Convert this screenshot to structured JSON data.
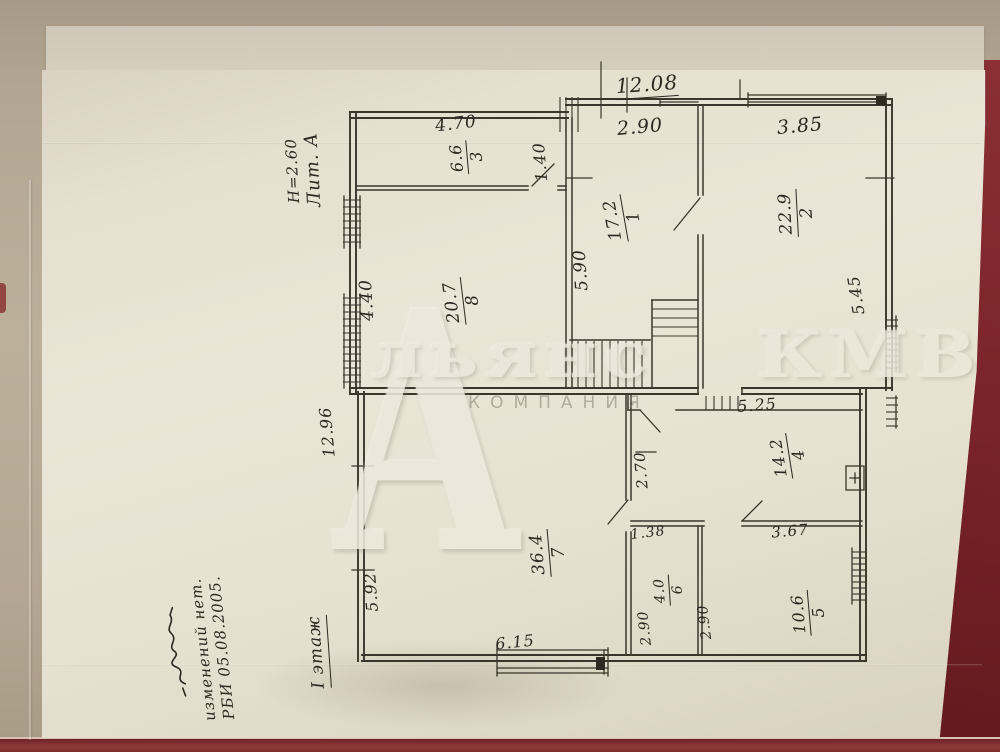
{
  "watermark": {
    "initial": "А",
    "name": "льянс КМВ",
    "subtitle": "КОМПАНИЯ"
  },
  "plan_annotations": {
    "building_label_lines": [
      "Н=2.60",
      "Лит. А"
    ],
    "floor_label": "I этаж",
    "notes": [
      "изменений нет.",
      "РБИ 05.08.2005."
    ]
  },
  "dims_h": [
    "12.08",
    "2.90",
    "3.85",
    "4.70",
    "5.25",
    "1.38",
    "3.67",
    "6.15"
  ],
  "dims_v": [
    "1.40",
    "4.40",
    "5.90",
    "5.45",
    "2.70",
    "5.92",
    "2.90",
    "2.90",
    "12.96"
  ],
  "rooms": [
    {
      "num": "3",
      "area": "6.6"
    },
    {
      "num": "1",
      "area": "17.2"
    },
    {
      "num": "2",
      "area": "22.9"
    },
    {
      "num": "8",
      "area": "20.7"
    },
    {
      "num": "4",
      "area": "14.2"
    },
    {
      "num": "7",
      "area": "36.4"
    },
    {
      "num": "6",
      "area": "4.0"
    },
    {
      "num": "5",
      "area": "10.6"
    }
  ],
  "colors": {
    "ink": "#2b2821",
    "paper": "#e8e2d2",
    "folder_red": "#7d262b",
    "table": "#b2a692"
  }
}
